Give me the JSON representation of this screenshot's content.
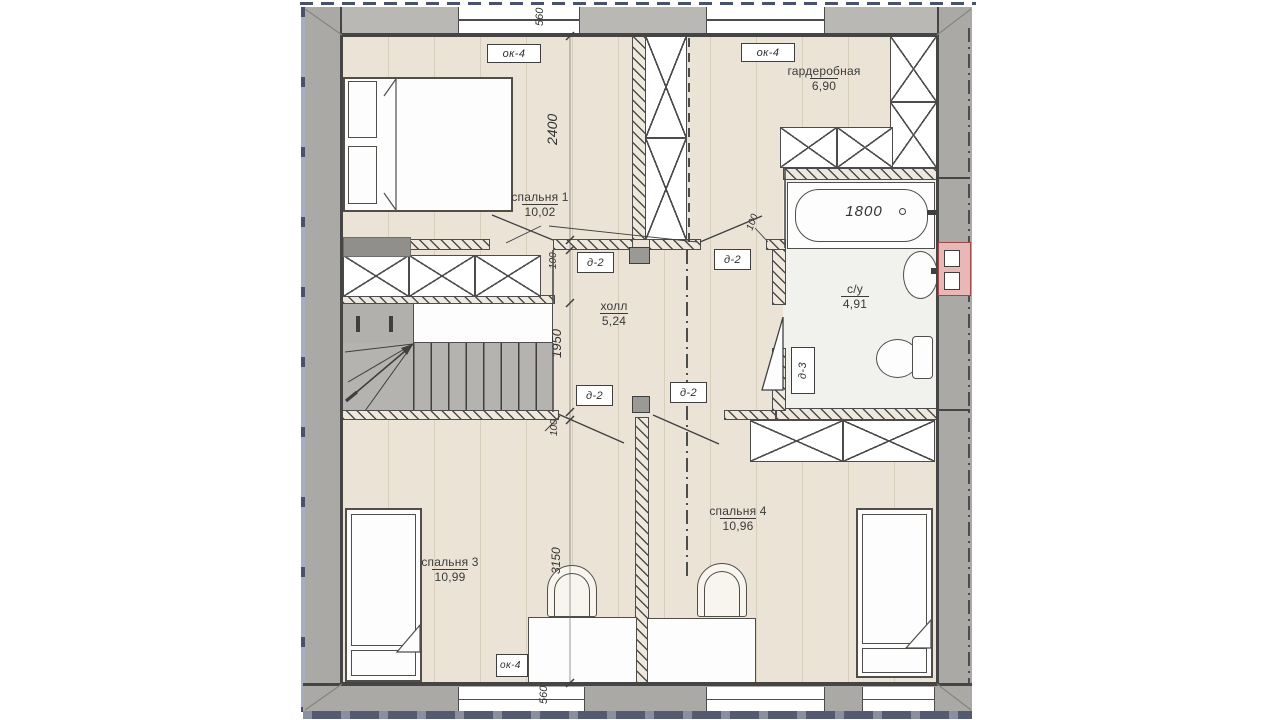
{
  "plan": {
    "rooms": [
      {
        "id": "bedroom1",
        "name": "спальня 1",
        "area": "10,02"
      },
      {
        "id": "wardrobe",
        "name": "гардеробная",
        "area": "6,90"
      },
      {
        "id": "hall",
        "name": "холл",
        "area": "5,24"
      },
      {
        "id": "bathroom",
        "name": "с/у",
        "area": "4,91"
      },
      {
        "id": "bedroom3",
        "name": "спальня 3",
        "area": "10,99"
      },
      {
        "id": "bedroom4",
        "name": "спальня 4",
        "area": "10,96"
      }
    ],
    "tags": {
      "window": "ок-4",
      "door": "д-2",
      "bath_door": "д-3"
    },
    "dims": {
      "win_top": "560",
      "bedroom1_depth": "2400",
      "gap_top": "100",
      "stairs": "1950",
      "gap_bottom": "100",
      "door_offset": "100",
      "bedroom3_depth": "3150",
      "win_bottom": "560",
      "tub_length": "1800"
    },
    "colors": {
      "floor": "#ebe4d6",
      "wall": "#aaa9a6",
      "bath_floor": "#f1f1ee",
      "vent": "#e9b8b6",
      "roof_edge": "#49526b",
      "line": "#3f3f3f"
    }
  }
}
